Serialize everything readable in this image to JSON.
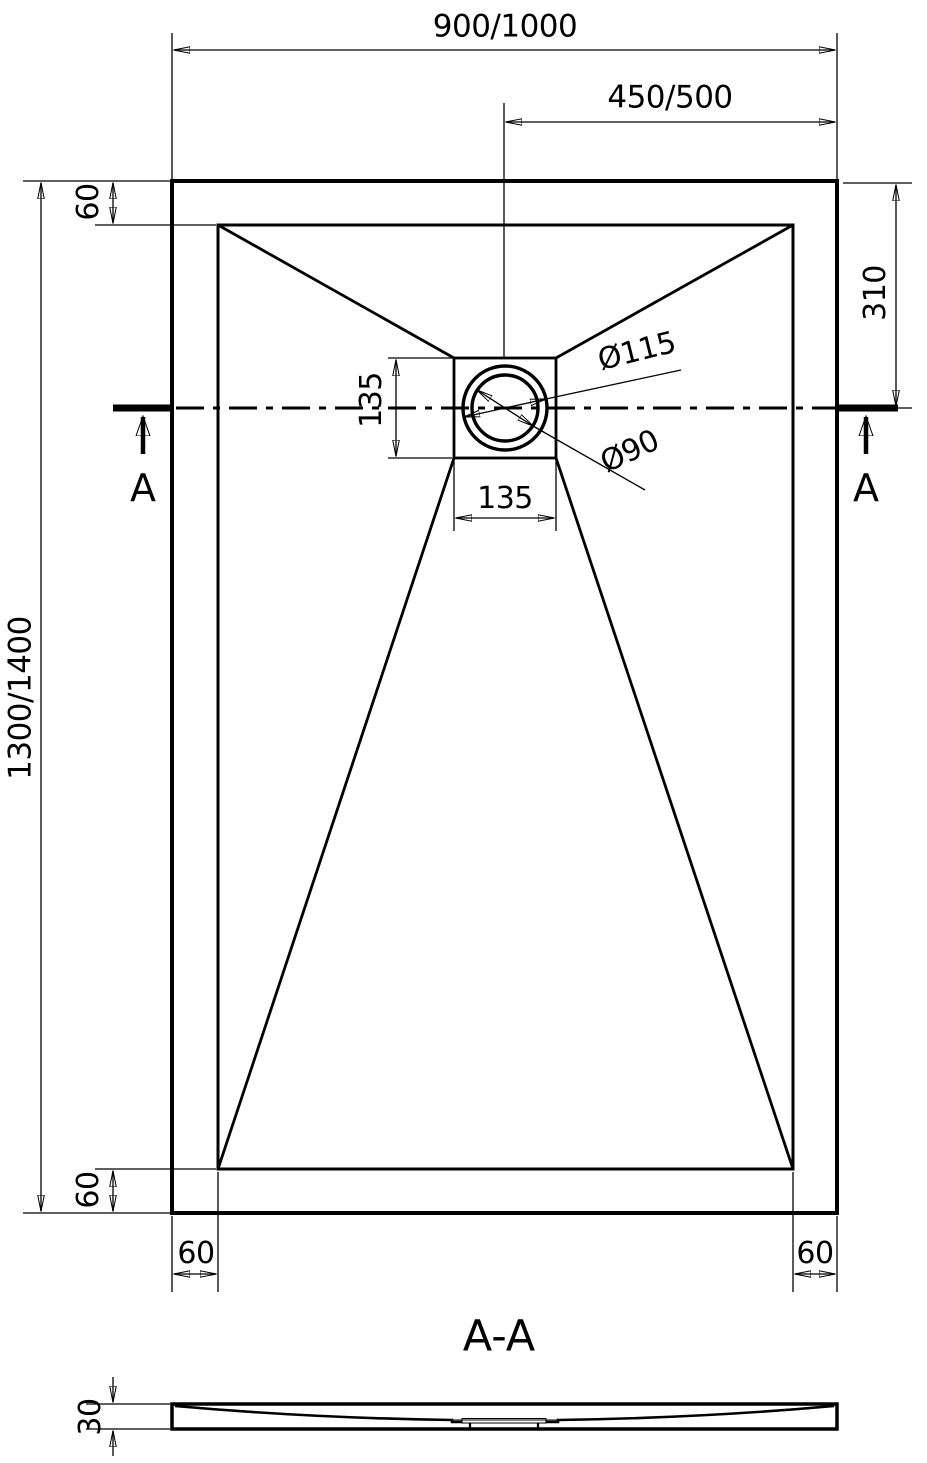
{
  "drawing": {
    "kind": "shower-tray technical drawing",
    "colors": {
      "line": "#000000",
      "background": "#ffffff"
    },
    "top_view": {
      "overall_width": "900/1000",
      "drain_offset_from_right": "450/500",
      "rim_top": "60",
      "drain_center_from_top": "310",
      "drain_box_height": "135",
      "drain_box_width": "135",
      "drain_outer_diameter": "Ø115",
      "drain_inner_diameter": "Ø90",
      "overall_length": "1300/1400",
      "rim_bottom": "60",
      "rim_left": "60",
      "rim_right": "60",
      "section_marker": "A"
    },
    "section_view": {
      "title": "A-A",
      "thickness": "30"
    }
  }
}
